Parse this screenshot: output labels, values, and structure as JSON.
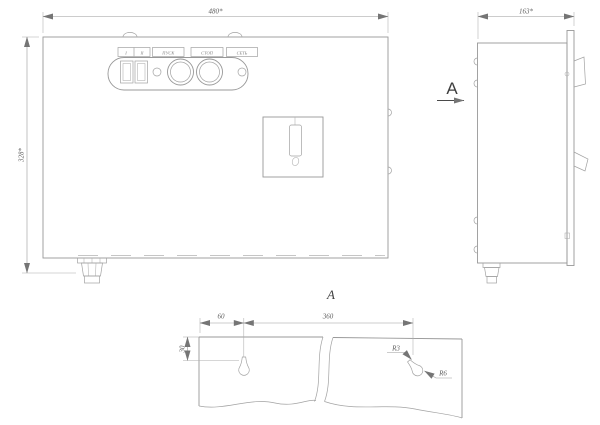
{
  "drawing": {
    "front_view": {
      "width_dim": "480*",
      "height_dim": "328*",
      "panel_labels": {
        "stage1": "I",
        "stage2": "II",
        "start": "ПУСК",
        "stop": "СТОП",
        "power": "СЕТЬ"
      }
    },
    "side_view": {
      "depth_dim": "163*",
      "view_arrow_label": "А"
    },
    "section_view": {
      "title": "А",
      "dim_left_offset": "60",
      "dim_hole_spacing": "360",
      "dim_top_offset": "30",
      "radius_small": "R3",
      "radius_large": "R6"
    },
    "colors": {
      "background": "#ffffff",
      "line": "#989898",
      "dimension_line": "#9a9a9a",
      "text": "#5c5c5c",
      "accent_dark": "#3f3f3f"
    }
  }
}
